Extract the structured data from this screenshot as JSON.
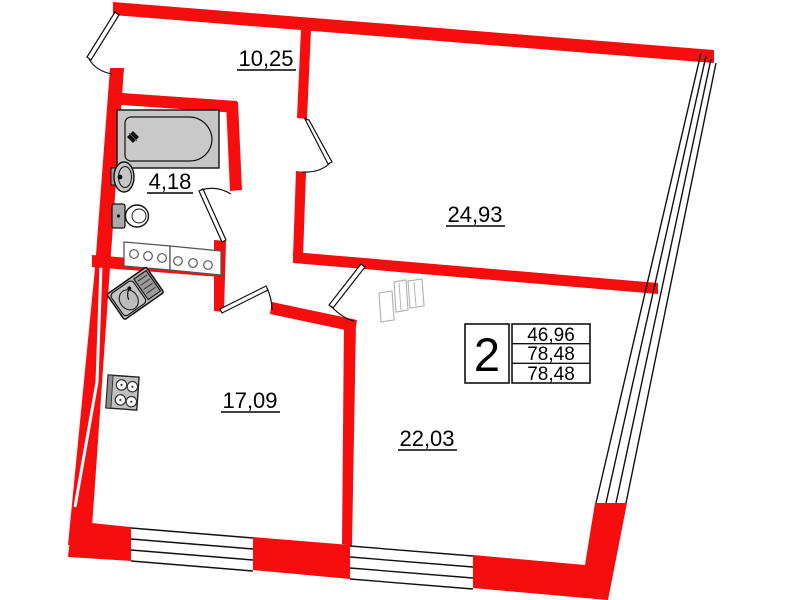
{
  "plan": {
    "type": "apartment-floor-plan",
    "rooms": [
      {
        "name": "hallway",
        "area_label": "10,25"
      },
      {
        "name": "bathroom",
        "area_label": "4,18"
      },
      {
        "name": "bedroom",
        "area_label": "24,93"
      },
      {
        "name": "kitchen",
        "area_label": "17,09"
      },
      {
        "name": "living-room",
        "area_label": "22,03"
      }
    ],
    "info_box": {
      "room_count": "2",
      "area_values": [
        "46,96",
        "78,48",
        "78,48"
      ]
    },
    "colors": {
      "wall": "#f60d0d",
      "outline": "#111111",
      "fixture_fill": "#c6c6c6"
    }
  }
}
